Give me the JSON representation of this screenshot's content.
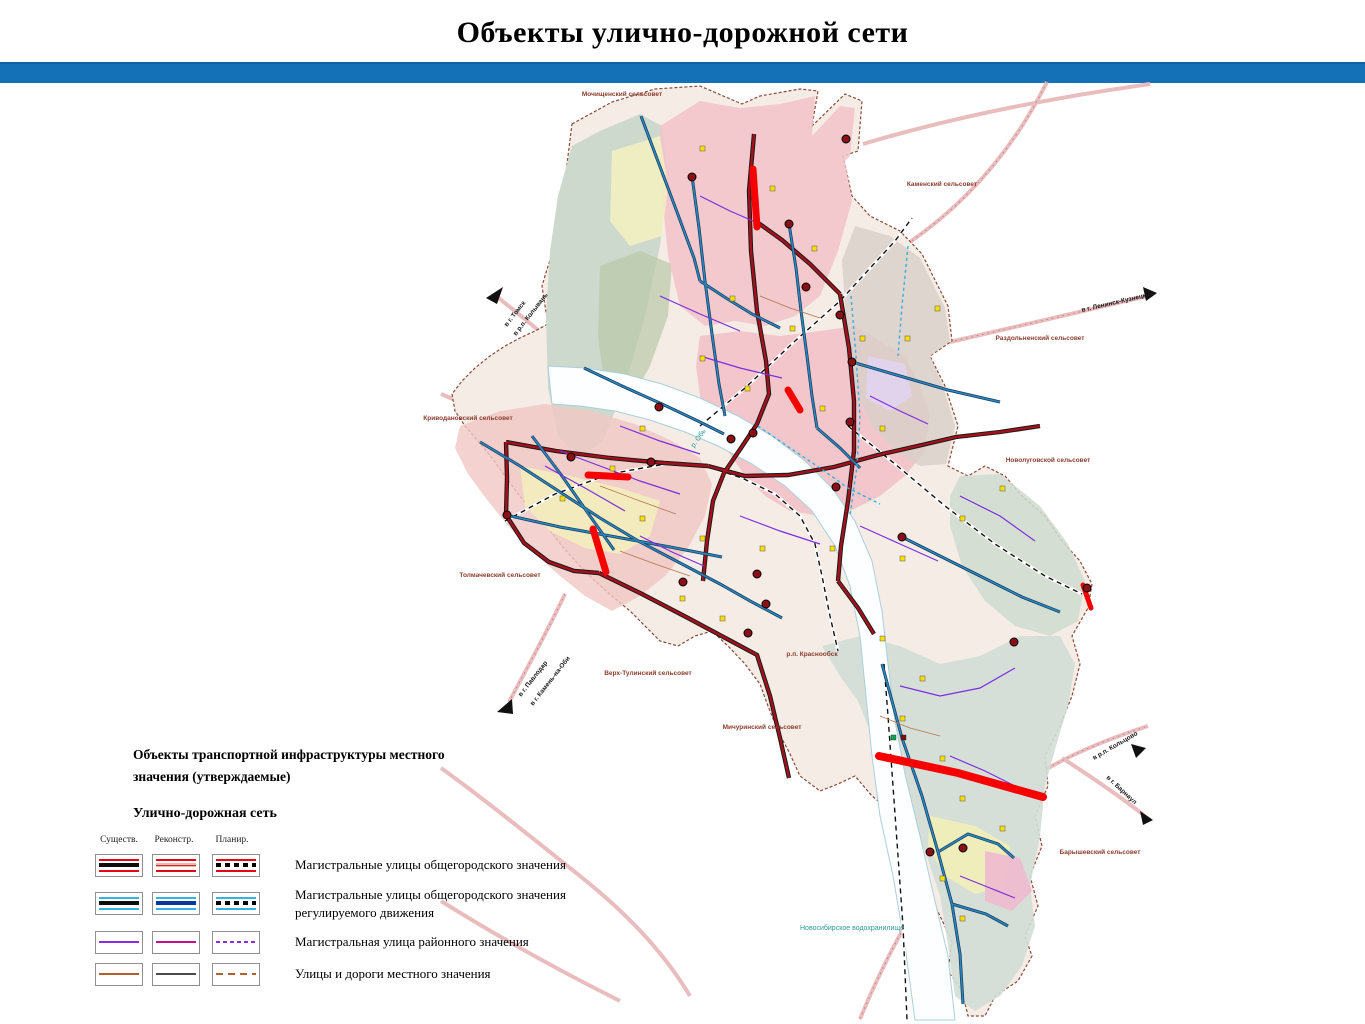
{
  "header": {
    "title": "Объекты улично-дорожной сети"
  },
  "legend": {
    "block_title": "Объекты транспортной инфраструктуры местного значения (утверждаемые)",
    "section_title": "Улично-дорожная сеть",
    "columns": [
      "Существ.",
      "Реконстр.",
      "Планир."
    ],
    "rows": [
      {
        "label": "Магистральные улицы общегородского значения"
      },
      {
        "label": "Магистральные улицы общегородского значения регулируемого движения"
      },
      {
        "label": "Магистральная улица районного значения"
      },
      {
        "label": "Улицы и дороги местного значения"
      }
    ]
  },
  "map": {
    "settlements": [
      "Мочищенский сельсовет",
      "Каменский сельсовет",
      "Раздольненский сельсовет",
      "Новолуговской сельсовет",
      "Криводановский сельсовет",
      "Толмачевский сельсовет",
      "Верх-Тулинский сельсовет",
      "Мичуринский сельсовет",
      "Барышевский сельсовет"
    ],
    "places": {
      "krasnoobsk": "р.п. Краснообск"
    },
    "water": {
      "reservoir": "Новосибирское водохранилище",
      "ob_river": "р. Обь"
    },
    "directions": {
      "tomsk": "в г. Томск",
      "kolyvan": "в р.п. Колывань",
      "pavlodar": "в г. Павлодар",
      "kamen": "в г. Камень-на-Оби",
      "leninsk": "в г. Ленинск-Кузнецкий",
      "koltsovo": "в р.п. Кольцово",
      "barnaul": "в г. Барнаул"
    }
  },
  "colors": {
    "header_bar": "#1571b7",
    "trunk_road": "#a6101a",
    "regulated_road": "#2f86bd",
    "district_road": "#8c2be2",
    "district_road_reconstr": "#c4108c",
    "local_road": "#b06030",
    "planned_highlight": "#f60000",
    "external_road": "#e9bcbe",
    "water_label": "#2c9898",
    "settlement_label": "#8a3c2c"
  }
}
